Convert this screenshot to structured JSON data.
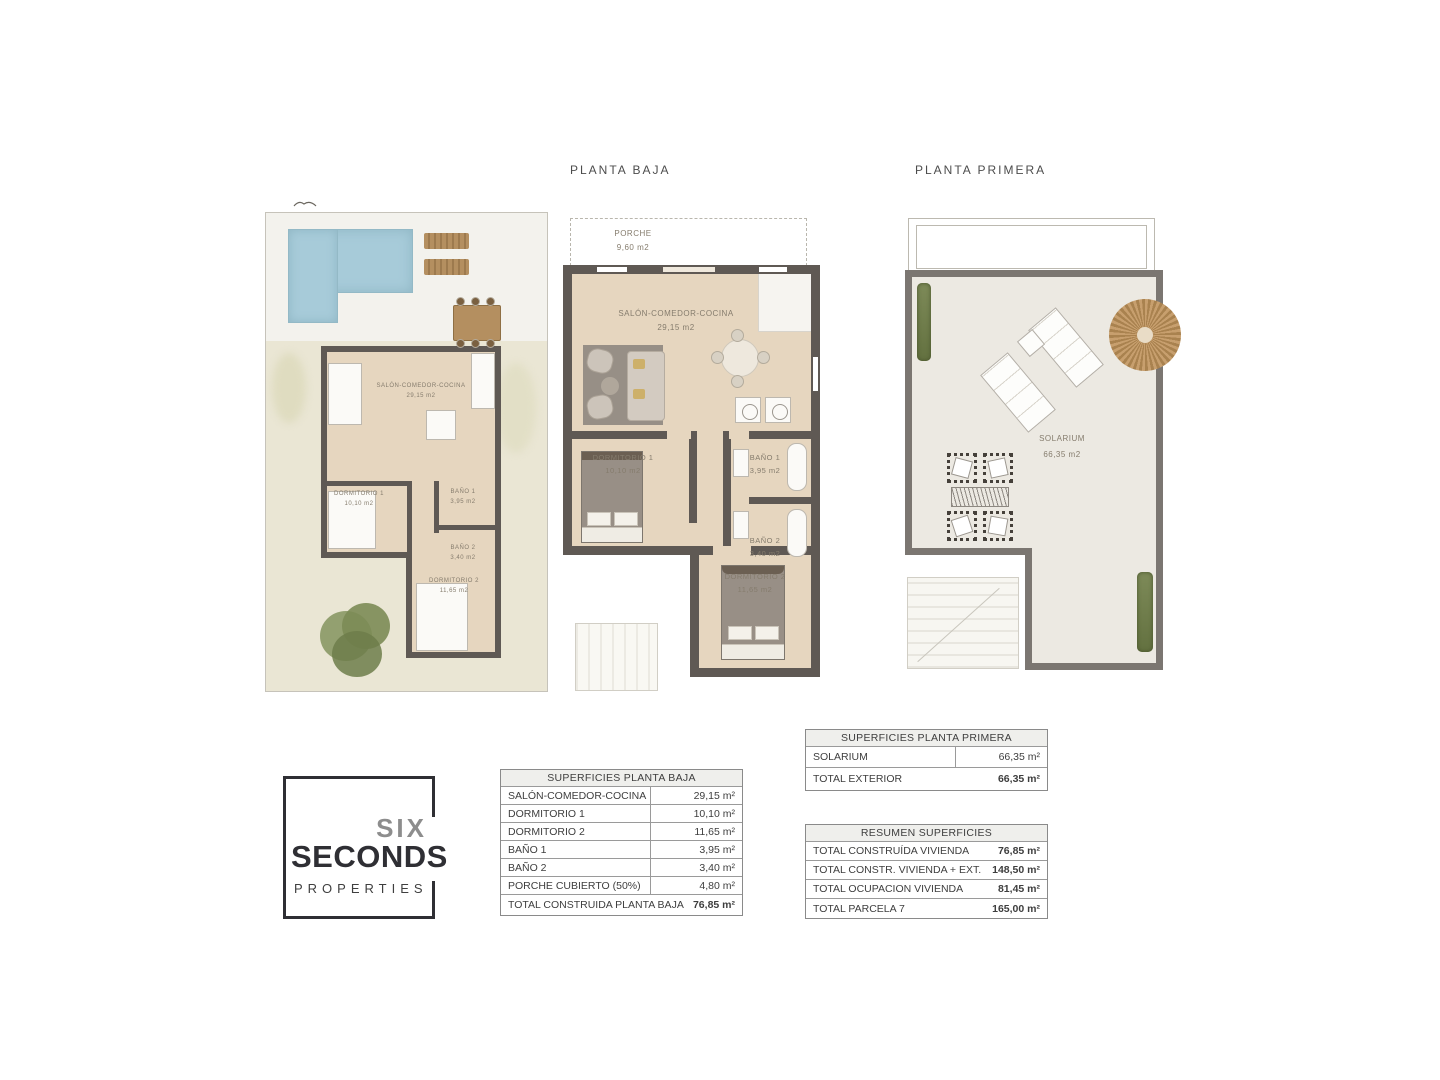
{
  "plans": {
    "ground_title": "PLANTA BAJA",
    "first_title": "PLANTA  PRIMERA"
  },
  "rooms": {
    "porche": {
      "label": "PORCHE",
      "area": "9,60 m2"
    },
    "salon": {
      "label": "SALÓN-COMEDOR-COCINA",
      "area": "29,15 m2"
    },
    "dorm1": {
      "label": "DORMITORIO 1",
      "area": "10,10 m2"
    },
    "bano1": {
      "label": "BAÑO 1",
      "area": "3,95 m2"
    },
    "bano2": {
      "label": "BAÑO 2",
      "area": "3,40 m2"
    },
    "dorm2": {
      "label": "DORMITORIO 2",
      "area": "11,65 m2"
    },
    "solarium": {
      "label": "SOLARIUM",
      "area": "66,35 m2"
    }
  },
  "tables": {
    "planta_baja": {
      "header": "SUPERFICIES PLANTA BAJA",
      "rows": [
        {
          "label": "SALÓN-COMEDOR-COCINA",
          "value": "29,15 m²"
        },
        {
          "label": "DORMITORIO 1",
          "value": "10,10 m²"
        },
        {
          "label": "DORMITORIO 2",
          "value": "11,65 m²"
        },
        {
          "label": "BAÑO 1",
          "value": "3,95 m²"
        },
        {
          "label": "BAÑO 2",
          "value": "3,40 m²"
        },
        {
          "label": "PORCHE CUBIERTO (50%)",
          "value": "4,80 m²"
        }
      ],
      "total": {
        "label": "TOTAL CONSTRUIDA PLANTA BAJA",
        "value": "76,85 m²"
      }
    },
    "planta_primera": {
      "header": "SUPERFICIES PLANTA PRIMERA",
      "rows": [
        {
          "label": "SOLARIUM",
          "value": "66,35 m²"
        }
      ],
      "total": {
        "label": "TOTAL EXTERIOR",
        "value": "66,35 m²"
      }
    },
    "resumen": {
      "header": "RESUMEN SUPERFICIES",
      "rows": [
        {
          "label": "TOTAL CONSTRUÍDA VIVIENDA",
          "value": "76,85 m²"
        },
        {
          "label": "TOTAL CONSTR. VIVIENDA + EXT.",
          "value": "148,50 m²"
        },
        {
          "label": "TOTAL OCUPACION VIVIENDA",
          "value": "81,45 m²"
        },
        {
          "label": "TOTAL PARCELA 7",
          "value": "165,00 m²"
        }
      ]
    }
  },
  "logo": {
    "word1": "SIX",
    "word2": "SECONDS",
    "word3": "PROPERTIES"
  },
  "colors": {
    "wall": "#5f5954",
    "first_floor_wall": "#7b7671",
    "wood_floor": "#e6d6bf",
    "pool": "#a7cbd9",
    "garden": "#eae6d4",
    "terrace": "#f3f2ed",
    "solarium_floor": "#ece9e2",
    "hedge": "#6f7e53",
    "parasol": "#c49c6c",
    "table_header_bg": "#efefec"
  }
}
